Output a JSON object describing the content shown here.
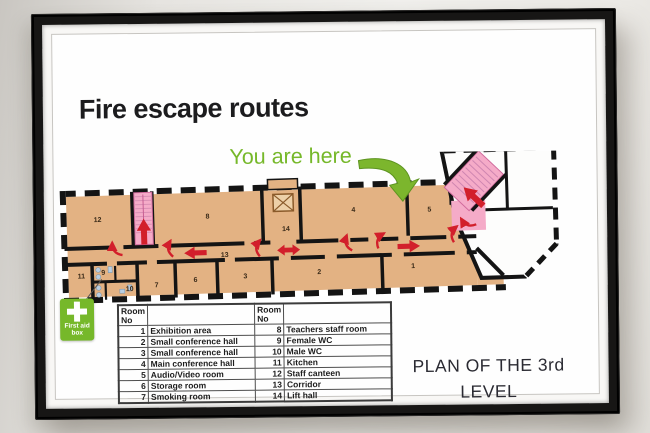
{
  "poster": {
    "title": "Fire escape routes",
    "you_are_here": "You are here",
    "plan_label": "PLAN OF THE 3rd LEVEL",
    "first_aid_label": "First aid box"
  },
  "legend": {
    "header_no": "Room No",
    "left": [
      {
        "no": "1",
        "name": "Exhibition area"
      },
      {
        "no": "2",
        "name": "Small conference hall"
      },
      {
        "no": "3",
        "name": "Small conference hall"
      },
      {
        "no": "4",
        "name": "Main conference hall"
      },
      {
        "no": "5",
        "name": "Audio/Video room"
      },
      {
        "no": "6",
        "name": "Storage room"
      },
      {
        "no": "7",
        "name": "Smoking room"
      }
    ],
    "right": [
      {
        "no": "8",
        "name": "Teachers staff room"
      },
      {
        "no": "9",
        "name": "Female WC"
      },
      {
        "no": "10",
        "name": "Male WC"
      },
      {
        "no": "11",
        "name": "Kitchen"
      },
      {
        "no": "12",
        "name": "Staff canteen"
      },
      {
        "no": "13",
        "name": "Corridor"
      },
      {
        "no": "14",
        "name": "Lift hall"
      }
    ]
  },
  "plan": {
    "room_numbers": [
      "12",
      "8",
      "4",
      "5",
      "14",
      "13",
      "11",
      "9",
      "10",
      "7",
      "6",
      "3",
      "2",
      "1"
    ]
  },
  "colors": {
    "accent_green": "#76b82a",
    "arrow_red": "#d21f2b",
    "room_tan": "#e3b283",
    "stair_pink": "#f5abc8",
    "frame_black": "#171615"
  }
}
